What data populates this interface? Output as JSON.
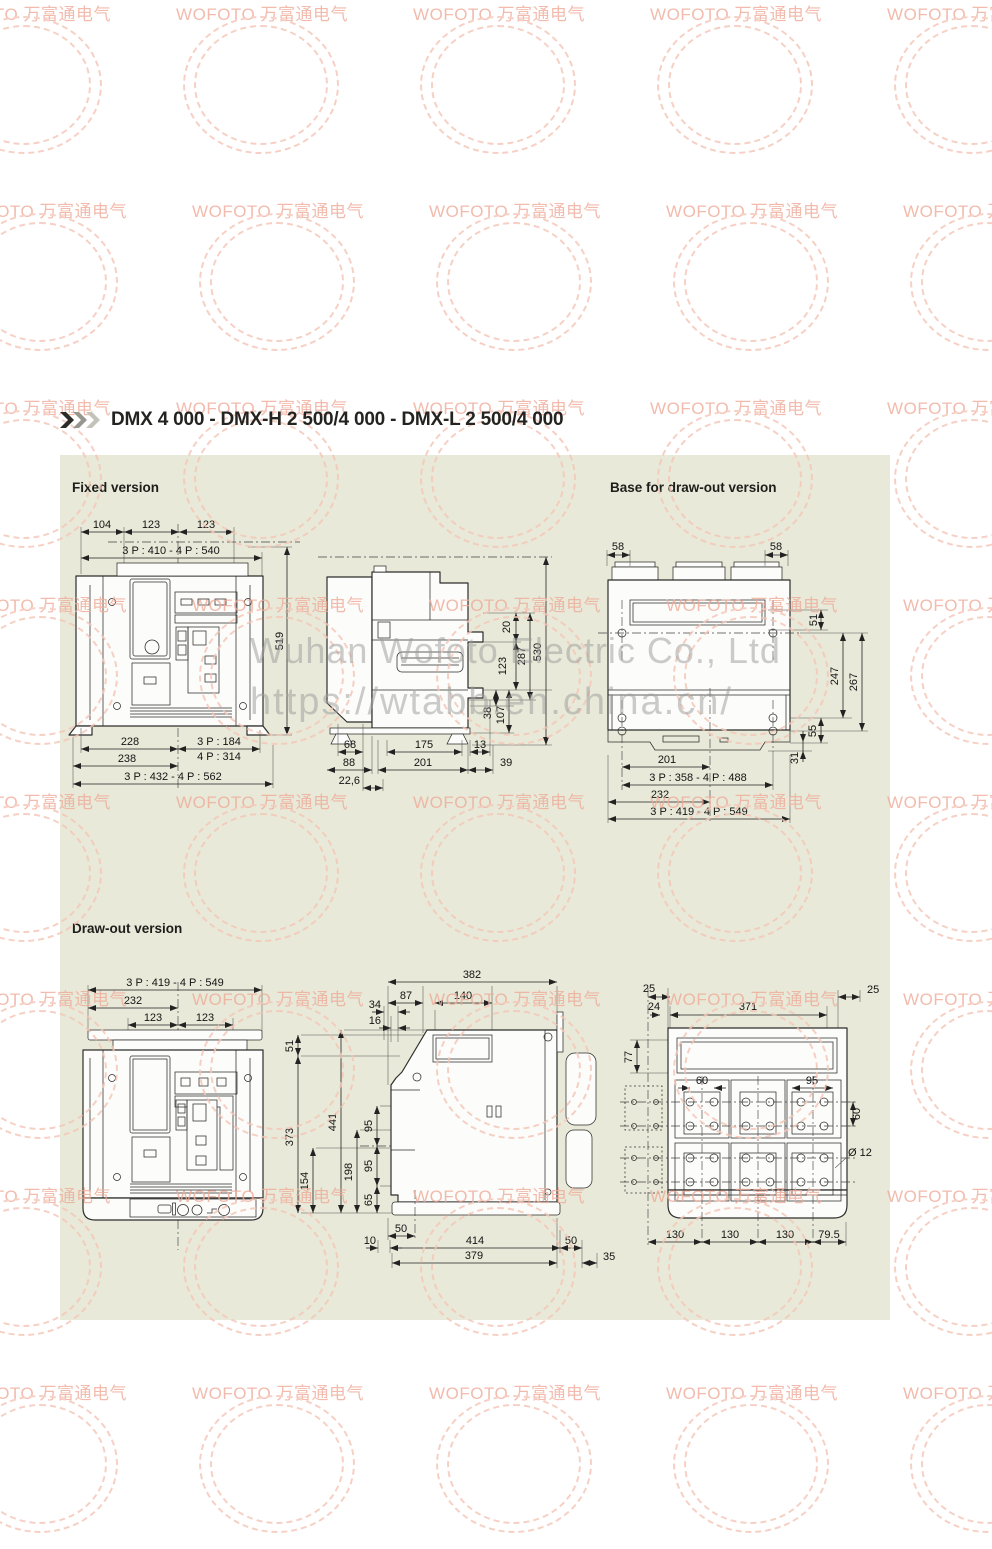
{
  "page": {
    "title": "DMX 4 000 - DMX-H 2 500/4 000 - DMX-L 2 500/4 000"
  },
  "sections": {
    "fixed": "Fixed version",
    "base": "Base for draw-out version",
    "drawout": "Draw-out version"
  },
  "watermark": {
    "stamp": "WOFOTO 万富通电气",
    "line1": "Wuhan Wofoto Electric Co., Ltd",
    "line2": "https://wtabb.en.china.cn/"
  },
  "fixed_front": {
    "d104": "104",
    "d123a": "123",
    "d123b": "123",
    "w_top": "3 P : 410 - 4 P : 540",
    "h519": "519",
    "d228": "228",
    "p184": "3 P : 184",
    "p314": "4 P : 314",
    "d238": "238",
    "w_bot": "3 P : 432  -  4 P : 562"
  },
  "fixed_side": {
    "d20": "20",
    "d123": "123",
    "d287": "287",
    "d530": "530",
    "d38": "38",
    "d107": "107",
    "d68": "68",
    "d175": "175",
    "d13": "13",
    "d88": "88",
    "d201": "201",
    "d39": "39",
    "d226": "22,6"
  },
  "base_view": {
    "d58l": "58",
    "d58r": "58",
    "d51": "51",
    "d247": "247",
    "d267": "267",
    "d55": "55",
    "d31": "31",
    "d201": "201",
    "p358": "3 P : 358 - 4 P : 488",
    "d232": "232",
    "p419": "3 P : 419 - 4 P : 549"
  },
  "do_front": {
    "p419": "3 P : 419  -  4 P : 549",
    "d232": "232",
    "d123a": "123",
    "d123b": "123",
    "d51": "51",
    "d373": "373",
    "d441": "441",
    "d198": "198",
    "d154": "154",
    "d95a": "95",
    "d95b": "95",
    "d65": "65"
  },
  "do_side": {
    "d382": "382",
    "d87": "87",
    "d140": "140",
    "d34": "34",
    "d16": "16",
    "d50a": "50",
    "d10": "10",
    "d414": "414",
    "d50b": "50",
    "d379": "379",
    "d35": "35"
  },
  "do_rear": {
    "d25l": "25",
    "d25r": "25",
    "d24": "24",
    "d371": "371",
    "d77": "77",
    "d60top": "60",
    "d95top": "95",
    "d60r": "60",
    "dia": "Ø 12",
    "d130a": "130",
    "d130b": "130",
    "d130c": "130",
    "d795": "79.5"
  }
}
